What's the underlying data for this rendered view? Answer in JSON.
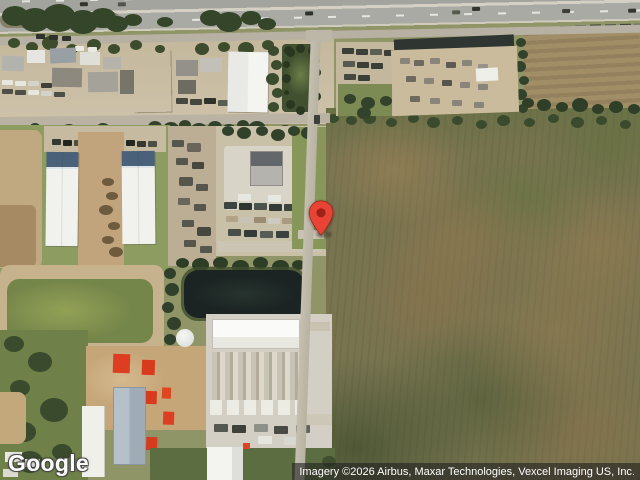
{
  "view": {
    "mode": "satellite"
  },
  "branding": {
    "logo_text": "Google"
  },
  "attribution": {
    "text": "Imagery ©2026 Airbus, Maxar Technologies, Vexcel Imaging US, Inc."
  },
  "pin": {
    "type": "location-marker",
    "fill": "#EA4335",
    "stroke": "#A52714",
    "hole": "#8E1B12",
    "tip_x": 321,
    "tip_y": 235
  }
}
